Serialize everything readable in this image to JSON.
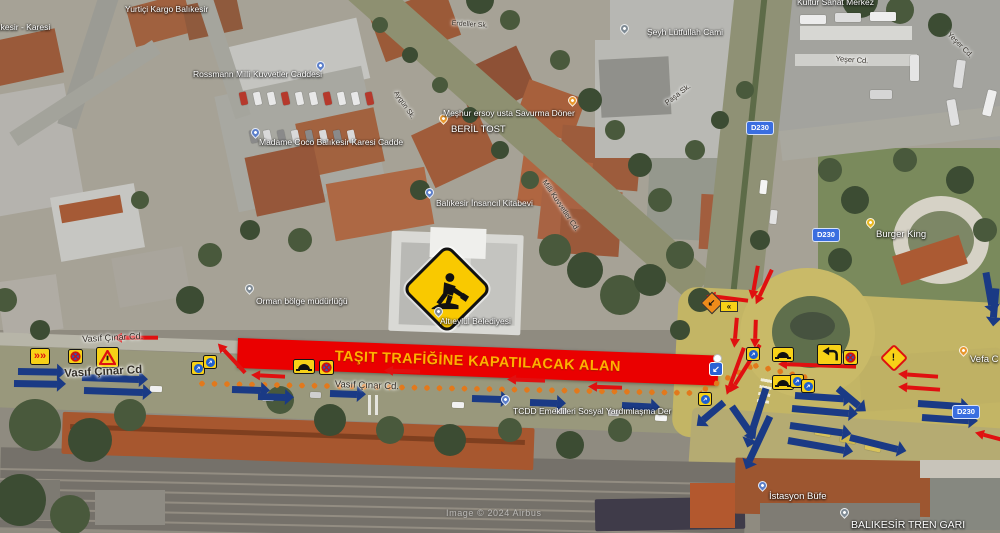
{
  "map": {
    "attribution": "Image © 2024 Airbus",
    "banner": {
      "text": "TAŞIT TRAFİĞİNE KAPATILACAK ALAN",
      "bg": "#ea0000",
      "fg": "#ffb000"
    },
    "colors": {
      "closed_arrow_red": "#e01010",
      "flow_arrow_navy": "#1a3a85",
      "dotted_line_orange": "#e2791c",
      "sign_yellow": "#f7d117",
      "shield_blue": "#3a6ee0"
    },
    "route_shields": [
      {
        "text": "D230",
        "x": 746,
        "y": 121
      },
      {
        "text": "D230",
        "x": 812,
        "y": 228
      },
      {
        "text": "D230",
        "x": 952,
        "y": 405
      }
    ],
    "poi_labels": [
      {
        "t": "Yurtiçi Kargo Balıkesir",
        "x": 125,
        "y": 4
      },
      {
        "t": "Balıkesir - Karesi",
        "x": -14,
        "y": 22
      },
      {
        "t": "Rossmann Milli Kuvvetler Caddesi",
        "x": 193,
        "y": 69
      },
      {
        "t": "Madame Coco Balıkesir Karesi Cadde",
        "x": 259,
        "y": 137
      },
      {
        "t": "Meşhur ersoy usta Savurma Döner",
        "x": 443,
        "y": 108
      },
      {
        "t": "BERİL TOST",
        "x": 451,
        "y": 124,
        "fs": 9.5
      },
      {
        "t": "Balıkesir İnsancıl Kitabevi",
        "x": 436,
        "y": 198
      },
      {
        "t": "Şeyh Lütfullah Cami",
        "x": 647,
        "y": 27
      },
      {
        "t": "Kültür Sanat Merkez",
        "x": 797,
        "y": -3
      },
      {
        "t": "Orman bölge müdürlüğü",
        "x": 256,
        "y": 296
      },
      {
        "t": "Altıeylül Belediyesi",
        "x": 440,
        "y": 316
      },
      {
        "t": "TCDD Emeklileri Sosyal Yardımlaşma Der",
        "x": 513,
        "y": 406
      },
      {
        "t": "İstasyon Büfe",
        "x": 769,
        "y": 491,
        "fs": 9.5
      },
      {
        "t": "BALIKESİR TREN GARI",
        "x": 851,
        "y": 519,
        "fs": 10.5
      },
      {
        "t": "Burger King",
        "x": 876,
        "y": 229,
        "fs": 9.5
      },
      {
        "t": "Vefa C",
        "x": 970,
        "y": 354,
        "fs": 9.5
      }
    ],
    "street_labels": [
      {
        "t": "Vasıf Çınar Cd.",
        "x": 82,
        "y": 334,
        "fs": 9,
        "rot": -3
      },
      {
        "t": "Vasıf Çınar Cd",
        "x": 64,
        "y": 368,
        "fs": 11.5,
        "rot": -3,
        "bold": 1
      },
      {
        "t": "Vasıf Çınar Cd.",
        "x": 335,
        "y": 379,
        "fs": 9.5,
        "rot": 2
      },
      {
        "t": "Yeşer Cd.",
        "x": 836,
        "y": 54,
        "fs": 7.5,
        "rot": 4
      },
      {
        "t": "Yeşer Cd.",
        "x": 952,
        "y": 30,
        "fs": 7.5,
        "rot": 45
      },
      {
        "t": "Paşa Sk.",
        "x": 663,
        "y": 100,
        "fs": 7.5,
        "rot": -38
      },
      {
        "t": "Milli Kuvvetler Cd.",
        "x": 548,
        "y": 178,
        "fs": 7.5,
        "rot": 56
      },
      {
        "t": "Erdeller Sk.",
        "x": 452,
        "y": 20,
        "fs": 7,
        "rot": 4
      },
      {
        "t": "Aygün Sk.",
        "x": 398,
        "y": 90,
        "fs": 7,
        "rot": 56
      }
    ],
    "pins": [
      {
        "x": 316,
        "y": 61,
        "c": "blue"
      },
      {
        "x": 251,
        "y": 128,
        "c": "blue"
      },
      {
        "x": 425,
        "y": 188,
        "c": "blue"
      },
      {
        "x": 501,
        "y": 395,
        "c": "blue"
      },
      {
        "x": 758,
        "y": 481,
        "c": "blue"
      },
      {
        "x": 568,
        "y": 96,
        "c": "orange"
      },
      {
        "x": 439,
        "y": 114,
        "c": "orange"
      },
      {
        "x": 959,
        "y": 346,
        "c": "orange"
      },
      {
        "x": 245,
        "y": 284,
        "c": "grey"
      },
      {
        "x": 434,
        "y": 307,
        "c": "grey"
      },
      {
        "x": 840,
        "y": 508,
        "c": "grey"
      },
      {
        "x": 620,
        "y": 24,
        "c": "grey"
      },
      {
        "x": 866,
        "y": 218,
        "c": "yellow"
      }
    ],
    "arrows": [
      {
        "x": 158,
        "y": 338,
        "a": 180,
        "l": 45,
        "c": "r"
      },
      {
        "x": 245,
        "y": 373,
        "a": 227,
        "l": 40,
        "c": "r"
      },
      {
        "x": 285,
        "y": 377,
        "a": 183,
        "l": 34,
        "c": "r"
      },
      {
        "x": 420,
        "y": 372,
        "a": 182,
        "l": 36,
        "c": "r"
      },
      {
        "x": 545,
        "y": 381,
        "a": 182,
        "l": 38,
        "c": "r"
      },
      {
        "x": 622,
        "y": 388,
        "a": 182,
        "l": 34,
        "c": "r"
      },
      {
        "x": 856,
        "y": 367,
        "a": 182,
        "l": 78,
        "c": "r"
      },
      {
        "x": 748,
        "y": 301,
        "a": 187,
        "l": 42,
        "c": "r"
      },
      {
        "x": 772,
        "y": 270,
        "a": 115,
        "l": 38,
        "c": "r"
      },
      {
        "x": 758,
        "y": 266,
        "a": 100,
        "l": 34,
        "c": "r"
      },
      {
        "x": 737,
        "y": 318,
        "a": 95,
        "l": 30,
        "c": "r"
      },
      {
        "x": 756,
        "y": 320,
        "a": 92,
        "l": 28,
        "c": "r"
      },
      {
        "x": 760,
        "y": 345,
        "a": 122,
        "l": 56,
        "c": "r"
      },
      {
        "x": 744,
        "y": 348,
        "a": 110,
        "l": 50,
        "c": "r"
      },
      {
        "x": 938,
        "y": 377,
        "a": 184,
        "l": 40,
        "c": "r"
      },
      {
        "x": 940,
        "y": 390,
        "a": 184,
        "l": 42,
        "c": "r"
      },
      {
        "x": 1002,
        "y": 440,
        "a": 195,
        "l": 28,
        "c": "r"
      },
      {
        "x": 18,
        "y": 371,
        "a": 1,
        "l": 48,
        "c": "b"
      },
      {
        "x": 14,
        "y": 383,
        "a": 1,
        "l": 52,
        "c": "b"
      },
      {
        "x": 82,
        "y": 377,
        "a": 2,
        "l": 66,
        "c": "b"
      },
      {
        "x": 84,
        "y": 390,
        "a": 2,
        "l": 68,
        "c": "b"
      },
      {
        "x": 232,
        "y": 389,
        "a": 2,
        "l": 38,
        "c": "b"
      },
      {
        "x": 258,
        "y": 396,
        "a": 2,
        "l": 36,
        "c": "b"
      },
      {
        "x": 330,
        "y": 393,
        "a": 2,
        "l": 36,
        "c": "b"
      },
      {
        "x": 472,
        "y": 398,
        "a": 2,
        "l": 38,
        "c": "b"
      },
      {
        "x": 530,
        "y": 402,
        "a": 2,
        "l": 36,
        "c": "b"
      },
      {
        "x": 622,
        "y": 405,
        "a": 3,
        "l": 38,
        "c": "b"
      },
      {
        "x": 766,
        "y": 388,
        "a": 108,
        "l": 62,
        "c": "b"
      },
      {
        "x": 724,
        "y": 402,
        "a": 140,
        "l": 36,
        "c": "b"
      },
      {
        "x": 770,
        "y": 416,
        "a": 115,
        "l": 58,
        "c": "b"
      },
      {
        "x": 795,
        "y": 395,
        "a": 4,
        "l": 58,
        "c": "b"
      },
      {
        "x": 792,
        "y": 408,
        "a": 5,
        "l": 66,
        "c": "b"
      },
      {
        "x": 790,
        "y": 425,
        "a": 8,
        "l": 62,
        "c": "b"
      },
      {
        "x": 788,
        "y": 440,
        "a": 10,
        "l": 66,
        "c": "b"
      },
      {
        "x": 850,
        "y": 437,
        "a": 14,
        "l": 58,
        "c": "b"
      },
      {
        "x": 838,
        "y": 388,
        "a": 40,
        "l": 36,
        "c": "b"
      },
      {
        "x": 918,
        "y": 403,
        "a": 4,
        "l": 52,
        "c": "b"
      },
      {
        "x": 922,
        "y": 417,
        "a": 4,
        "l": 56,
        "c": "b"
      },
      {
        "x": 986,
        "y": 272,
        "a": 80,
        "l": 42,
        "c": "b"
      },
      {
        "x": 996,
        "y": 288,
        "a": 95,
        "l": 38,
        "c": "b"
      },
      {
        "x": 732,
        "y": 406,
        "a": 55,
        "l": 40,
        "c": "b"
      }
    ],
    "dotted_strips": [
      {
        "x": 196,
        "y": 383,
        "l": 506,
        "a": 1.1
      },
      {
        "x": 700,
        "y": 391,
        "l": 58,
        "a": -26
      },
      {
        "x": 750,
        "y": 364,
        "l": 66,
        "a": 13
      }
    ],
    "signs": [
      {
        "t": "merge",
        "x": 30,
        "y": 348
      },
      {
        "t": "nostop",
        "x": 68,
        "y": 349
      },
      {
        "t": "yield",
        "x": 96,
        "y": 347
      },
      {
        "t": "round",
        "x": 191,
        "y": 361
      },
      {
        "t": "round",
        "x": 203,
        "y": 355
      },
      {
        "t": "bump",
        "x": 293,
        "y": 359
      },
      {
        "t": "nostop",
        "x": 319,
        "y": 360
      },
      {
        "t": "round",
        "x": 746,
        "y": 347
      },
      {
        "t": "bump",
        "x": 772,
        "y": 347
      },
      {
        "t": "hook",
        "x": 817,
        "y": 344
      },
      {
        "t": "nostop",
        "x": 843,
        "y": 350
      },
      {
        "t": "bump",
        "x": 772,
        "y": 375
      },
      {
        "t": "round",
        "x": 790,
        "y": 374
      },
      {
        "t": "round",
        "x": 801,
        "y": 379
      },
      {
        "t": "round",
        "x": 698,
        "y": 392
      },
      {
        "t": "bluearrow",
        "x": 709,
        "y": 362
      },
      {
        "t": "dot",
        "x": 713,
        "y": 354
      },
      {
        "t": "warn",
        "x": 884,
        "y": 348
      },
      {
        "t": "chev",
        "x": 704,
        "y": 295
      }
    ]
  }
}
